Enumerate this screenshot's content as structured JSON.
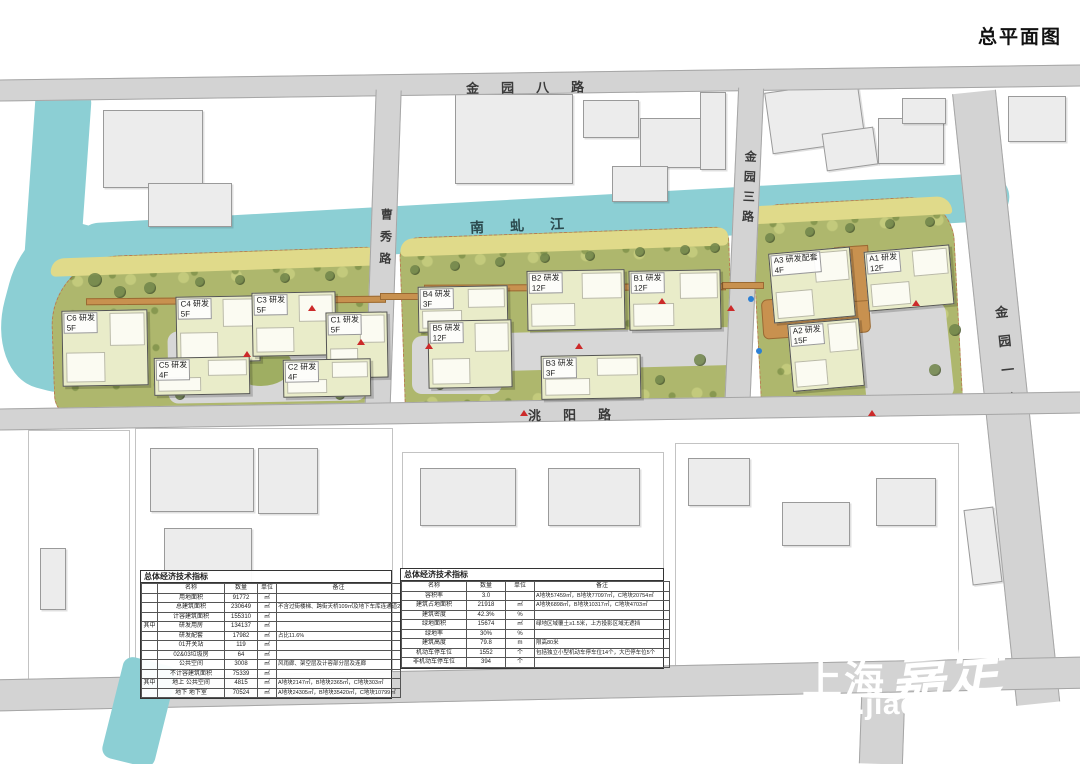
{
  "title": "总平面图",
  "river": {
    "label": "南虬江"
  },
  "roads": [
    {
      "id": "jinyuan8",
      "label": "金园八路"
    },
    {
      "id": "caoxiu",
      "label": "曹秀路"
    },
    {
      "id": "jinyuan3",
      "label": "金园三路"
    },
    {
      "id": "jinyuan1",
      "label": "金园一路"
    },
    {
      "id": "taoyang",
      "label": "洮阳路"
    }
  ],
  "colors": {
    "river": "#8ccfd4",
    "road": "#d3d3d3",
    "site_green": "#aeb76d",
    "waterfront": "#e0da8a",
    "building": "#e9ecc9",
    "walkway": "#c8914f",
    "accent_red": "#cc2a2a"
  },
  "buildings": [
    {
      "id": "C6",
      "name": "C6 研发",
      "floors": "5F",
      "x": 62,
      "y": 310,
      "w": 86,
      "h": 76,
      "rot": -1
    },
    {
      "id": "C4",
      "name": "C4 研发",
      "floors": "5F",
      "x": 176,
      "y": 296,
      "w": 84,
      "h": 66,
      "rot": -1
    },
    {
      "id": "C3",
      "name": "C3 研发",
      "floors": "5F",
      "x": 252,
      "y": 292,
      "w": 84,
      "h": 64,
      "rot": -1
    },
    {
      "id": "C1",
      "name": "C1 研发",
      "floors": "5F",
      "x": 326,
      "y": 312,
      "w": 62,
      "h": 66,
      "rot": -1
    },
    {
      "id": "C5",
      "name": "C5 研发",
      "floors": "4F",
      "x": 154,
      "y": 357,
      "w": 96,
      "h": 38,
      "rot": -1
    },
    {
      "id": "C2",
      "name": "C2 研发",
      "floors": "4F",
      "x": 283,
      "y": 359,
      "w": 88,
      "h": 38,
      "rot": -1
    },
    {
      "id": "B4",
      "name": "B4 研发",
      "floors": "3F",
      "x": 418,
      "y": 286,
      "w": 90,
      "h": 46,
      "rot": -1
    },
    {
      "id": "B5",
      "name": "B5 研发",
      "floors": "12F",
      "x": 428,
      "y": 320,
      "w": 84,
      "h": 68,
      "rot": -1
    },
    {
      "id": "B2",
      "name": "B2 研发",
      "floors": "12F",
      "x": 527,
      "y": 270,
      "w": 98,
      "h": 60,
      "rot": -1
    },
    {
      "id": "B1",
      "name": "B1 研发",
      "floors": "12F",
      "x": 629,
      "y": 270,
      "w": 92,
      "h": 60,
      "rot": -1
    },
    {
      "id": "B3",
      "name": "B3 研发",
      "floors": "3F",
      "x": 541,
      "y": 355,
      "w": 100,
      "h": 44,
      "rot": -1
    },
    {
      "id": "A3",
      "name": "A3 研发配套",
      "floors": "4F",
      "x": 771,
      "y": 250,
      "w": 82,
      "h": 70,
      "rot": -5
    },
    {
      "id": "A1",
      "name": "A1 研发",
      "floors": "12F",
      "x": 866,
      "y": 248,
      "w": 86,
      "h": 60,
      "rot": -5
    },
    {
      "id": "A2",
      "name": "A2 研发",
      "floors": "15F",
      "x": 790,
      "y": 321,
      "w": 72,
      "h": 68,
      "rot": -5
    }
  ],
  "tables": {
    "left": {
      "title": "总体经济技术指标",
      "columns": [
        "",
        "名称",
        "数量",
        "单位",
        "备注"
      ],
      "rows": [
        [
          "",
          "用地面积",
          "91772",
          "㎡",
          ""
        ],
        [
          "",
          "总建筑面积",
          "230649",
          "㎡",
          "不含过街楼梯、跨街天桥109㎡及地下车库连通道285㎡"
        ],
        [
          "",
          "计容建筑面积",
          "155310",
          "㎡",
          ""
        ],
        [
          "其中",
          "研发用房",
          "134137",
          "㎡",
          ""
        ],
        [
          "",
          "研发配套",
          "17982",
          "㎡",
          "占比11.6%"
        ],
        [
          "",
          "01开关站",
          "119",
          "㎡",
          ""
        ],
        [
          "",
          "02&03垃圾房",
          "64",
          "㎡",
          ""
        ],
        [
          "",
          "公共空间",
          "3008",
          "㎡",
          "风雨廊、架空层及计容部分层及连廊"
        ],
        [
          "",
          "不计容建筑面积",
          "75339",
          "㎡",
          ""
        ],
        [
          "其中",
          "地上 公共空间",
          "4815",
          "㎡",
          "A地块2147㎡，B地块2365㎡，C地块303㎡"
        ],
        [
          "",
          "地下 地下室",
          "70524",
          "㎡",
          "A地块24305㎡，B地块35420㎡，C地块10799㎡"
        ]
      ]
    },
    "center": {
      "title": "总体经济技术指标",
      "columns": [
        "名称",
        "数量",
        "单位",
        "备注"
      ],
      "rows": [
        [
          "容积率",
          "3.0",
          "",
          "A地块57459㎡，B地块77097㎡，C地块20754㎡"
        ],
        [
          "建筑占地面积",
          "21918",
          "㎡",
          "A地块6898㎡，B地块10317㎡，C地块4703㎡"
        ],
        [
          "建筑密度",
          "42.3%",
          "%",
          ""
        ],
        [
          "绿地面积",
          "15674",
          "㎡",
          "绿地区域覆土≥1.5米，上方投影区域无遮挡"
        ],
        [
          "绿地率",
          "30%",
          "%",
          ""
        ],
        [
          "建筑高度",
          "79.8",
          "m",
          "限高80米"
        ],
        [
          "机动车停车位",
          "1552",
          "个",
          "包括独立小型机动车停车位14个，大巴停车位5个"
        ],
        [
          "非机动车停车位",
          "394",
          "个",
          ""
        ]
      ]
    }
  },
  "watermark": {
    "cn1": "上海",
    "cn2": "嘉定",
    "url": "www.jiading.g"
  },
  "context": {
    "parcels": [
      [
        135,
        428,
        258,
        260
      ],
      [
        402,
        452,
        262,
        212
      ],
      [
        675,
        443,
        284,
        246
      ],
      [
        28,
        430,
        102,
        250
      ]
    ],
    "buildings": [
      [
        103,
        110,
        100,
        78,
        0
      ],
      [
        148,
        183,
        84,
        44,
        0
      ],
      [
        455,
        94,
        118,
        90,
        0
      ],
      [
        583,
        100,
        56,
        38,
        0
      ],
      [
        640,
        118,
        74,
        50,
        0
      ],
      [
        612,
        166,
        56,
        36,
        0
      ],
      [
        700,
        92,
        26,
        78,
        0
      ],
      [
        768,
        86,
        94,
        62,
        -8
      ],
      [
        824,
        130,
        52,
        38,
        -8
      ],
      [
        878,
        118,
        66,
        46,
        0
      ],
      [
        902,
        98,
        44,
        26,
        0
      ],
      [
        1008,
        96,
        58,
        46,
        0
      ],
      [
        150,
        448,
        104,
        64,
        0
      ],
      [
        164,
        528,
        88,
        56,
        0
      ],
      [
        258,
        448,
        60,
        66,
        0
      ],
      [
        40,
        548,
        26,
        62,
        0
      ],
      [
        420,
        468,
        96,
        58,
        0
      ],
      [
        548,
        468,
        92,
        58,
        0
      ],
      [
        688,
        458,
        62,
        48,
        0
      ],
      [
        782,
        502,
        68,
        44,
        0
      ],
      [
        876,
        478,
        60,
        48,
        0
      ],
      [
        968,
        508,
        30,
        76,
        -7
      ],
      [
        1005,
        556,
        26,
        56,
        -7
      ]
    ]
  },
  "site_features": {
    "trees": [
      [
        95,
        280,
        7
      ],
      [
        120,
        292,
        6
      ],
      [
        150,
        288,
        6
      ],
      [
        200,
        282,
        5
      ],
      [
        240,
        280,
        5
      ],
      [
        285,
        278,
        5
      ],
      [
        330,
        276,
        5
      ],
      [
        90,
        330,
        6
      ],
      [
        80,
        360,
        6
      ],
      [
        415,
        270,
        5
      ],
      [
        455,
        266,
        5
      ],
      [
        500,
        262,
        5
      ],
      [
        545,
        258,
        5
      ],
      [
        590,
        256,
        5
      ],
      [
        640,
        252,
        5
      ],
      [
        685,
        250,
        5
      ],
      [
        715,
        248,
        5
      ],
      [
        770,
        238,
        5
      ],
      [
        810,
        232,
        5
      ],
      [
        850,
        228,
        5
      ],
      [
        890,
        224,
        5
      ],
      [
        930,
        222,
        5
      ],
      [
        180,
        395,
        5
      ],
      [
        340,
        395,
        5
      ],
      [
        440,
        385,
        5
      ],
      [
        660,
        380,
        5
      ],
      [
        700,
        360,
        6
      ],
      [
        745,
        385,
        5
      ],
      [
        955,
        330,
        6
      ],
      [
        935,
        370,
        6
      ]
    ],
    "entrance_markers": [
      [
        243,
        351
      ],
      [
        308,
        305
      ],
      [
        357,
        339
      ],
      [
        425,
        343
      ],
      [
        575,
        343
      ],
      [
        658,
        298
      ],
      [
        727,
        305
      ],
      [
        912,
        300
      ],
      [
        868,
        410
      ],
      [
        520,
        410
      ]
    ],
    "info_markers": [
      [
        748,
        296
      ],
      [
        756,
        348
      ]
    ]
  }
}
